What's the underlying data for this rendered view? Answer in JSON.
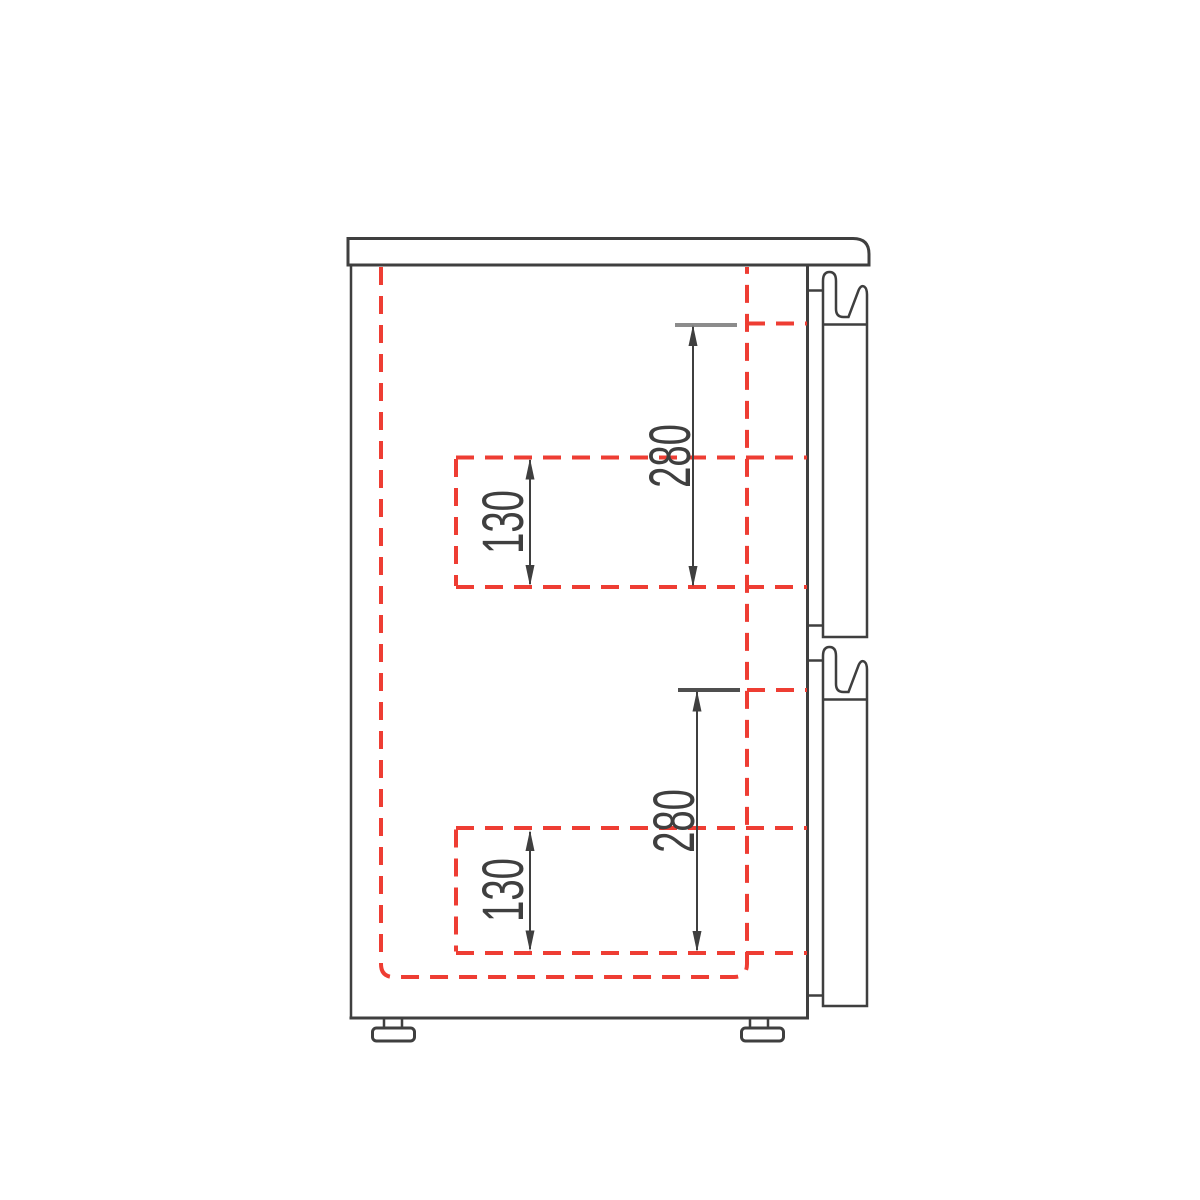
{
  "dimensions": {
    "upper_280": "280",
    "upper_130": "130",
    "lower_280": "280",
    "lower_130": "130"
  },
  "colors": {
    "outline": "#3f3f3f",
    "dashed_red": "#ee3d33",
    "extension_gray_upper": "#8c8c8c",
    "extension_gray_lower": "#4f4f4f",
    "background": "#ffffff"
  }
}
